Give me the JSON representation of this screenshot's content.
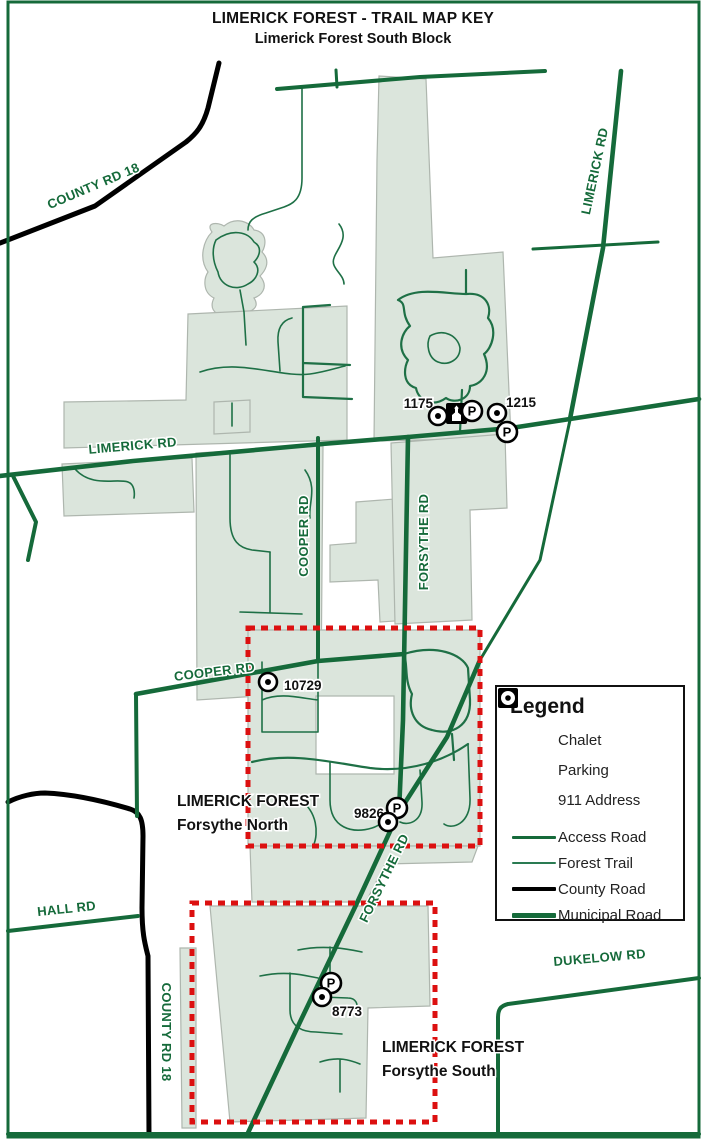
{
  "title": {
    "line1": "LIMERICK FOREST - TRAIL MAP KEY",
    "line2": "Limerick Forest South Block"
  },
  "roads": {
    "county_rd_18_nw": "COUNTY RD 18",
    "limerick_rd_diagonal": "LIMERICK RD",
    "limerick_rd_horizontal": "LIMERICK RD",
    "cooper_rd_vertical": "COOPER RD",
    "forsythe_rd_vertical": "FORSYTHE RD",
    "cooper_rd_horizontal": "COOPER RD",
    "forsythe_rd_diagonal": "FORSYTHE RD",
    "hall_rd": "HALL RD",
    "county_rd_18_south": "COUNTY RD 18",
    "dukelow_rd": "DUKELOW RD"
  },
  "addresses": {
    "n1175": "1175",
    "n1215": "1215",
    "n10729": "10729",
    "n9826": "9826",
    "n8773": "8773"
  },
  "areas": {
    "forsythe_north_line1": "LIMERICK FOREST",
    "forsythe_north_line2": "Forsythe North",
    "forsythe_south_line1": "LIMERICK FOREST",
    "forsythe_south_line2": "Forsythe South"
  },
  "icons": {
    "parking_letter": "P"
  },
  "legend": {
    "title": "Legend",
    "items": [
      {
        "icon": "chalet-icon",
        "label": "Chalet"
      },
      {
        "icon": "parking-icon",
        "label": "Parking"
      },
      {
        "icon": "911-address-icon",
        "label": "911 Address"
      },
      {
        "icon": "access-road-line",
        "label": "Access Road"
      },
      {
        "icon": "forest-trail-line",
        "label": "Forest Trail"
      },
      {
        "icon": "county-road-line",
        "label": "County Road"
      },
      {
        "icon": "municipal-road-line",
        "label": "Municipal Road"
      }
    ]
  },
  "colors": {
    "municipal_road": "#156a3a",
    "access_road": "#156a3a",
    "forest_trail": "#1e7046",
    "county_road": "#000000",
    "forest_fill": "#dbe5dc",
    "boundary_highlight": "#dc1010",
    "road_label_green": "#156a3a"
  }
}
